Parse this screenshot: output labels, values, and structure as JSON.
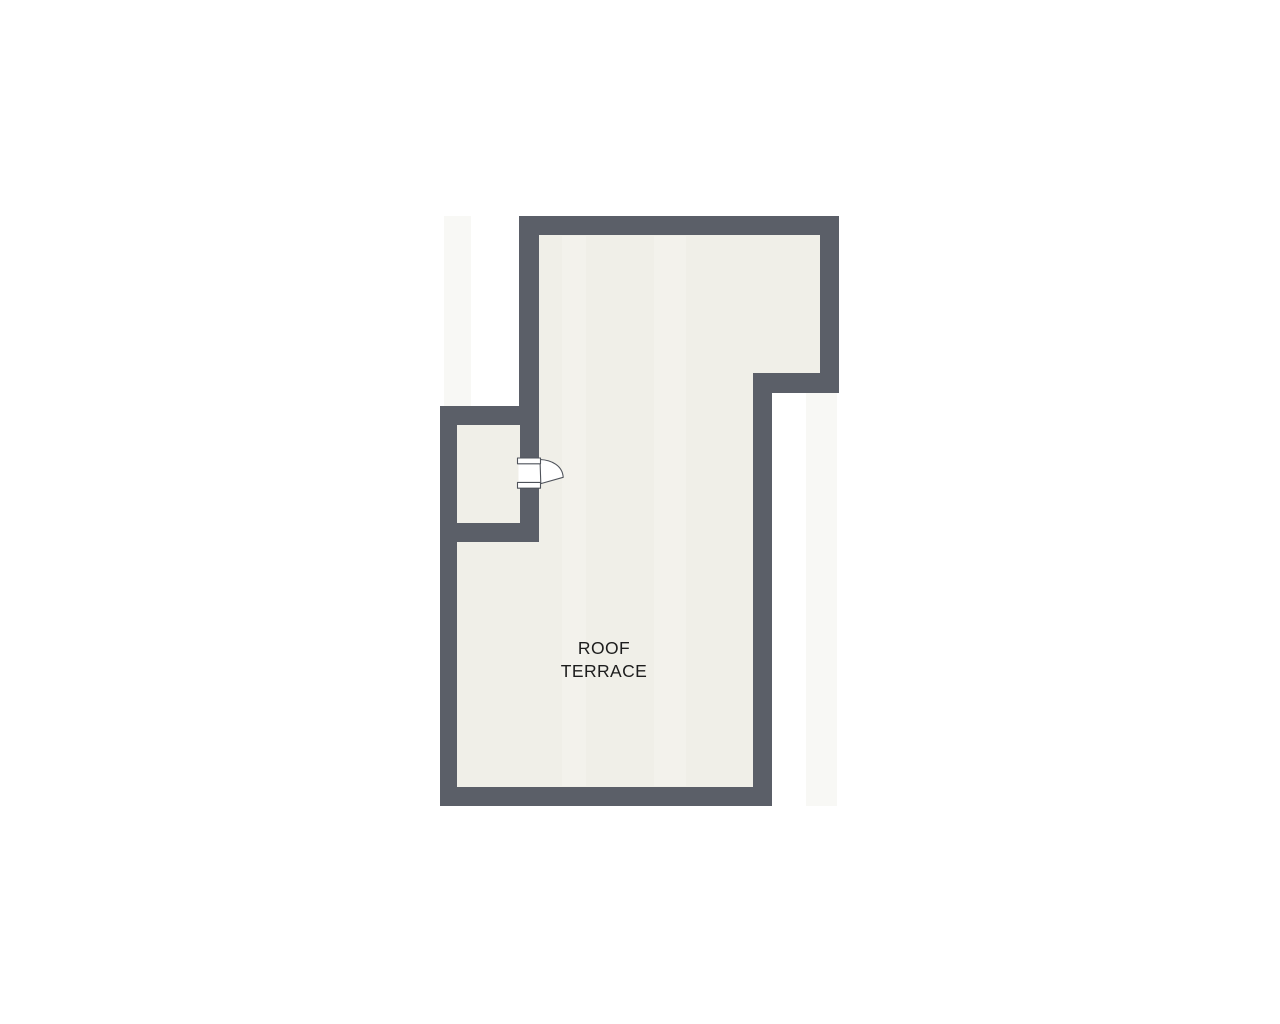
{
  "floorplan": {
    "room": {
      "label_line1": "ROOF",
      "label_line2": "TERRACE",
      "full_label": "ROOF TERRACE"
    },
    "door": {
      "type": "single-swing"
    },
    "colors": {
      "background": "#ffffff",
      "wall": "#5b5f68",
      "floor": "#f0efe8",
      "door_fill": "#ffffff",
      "door_outline": "#4f535b",
      "label_text": "#1d1d1d",
      "artifact_band": "#f8f8f5"
    }
  }
}
